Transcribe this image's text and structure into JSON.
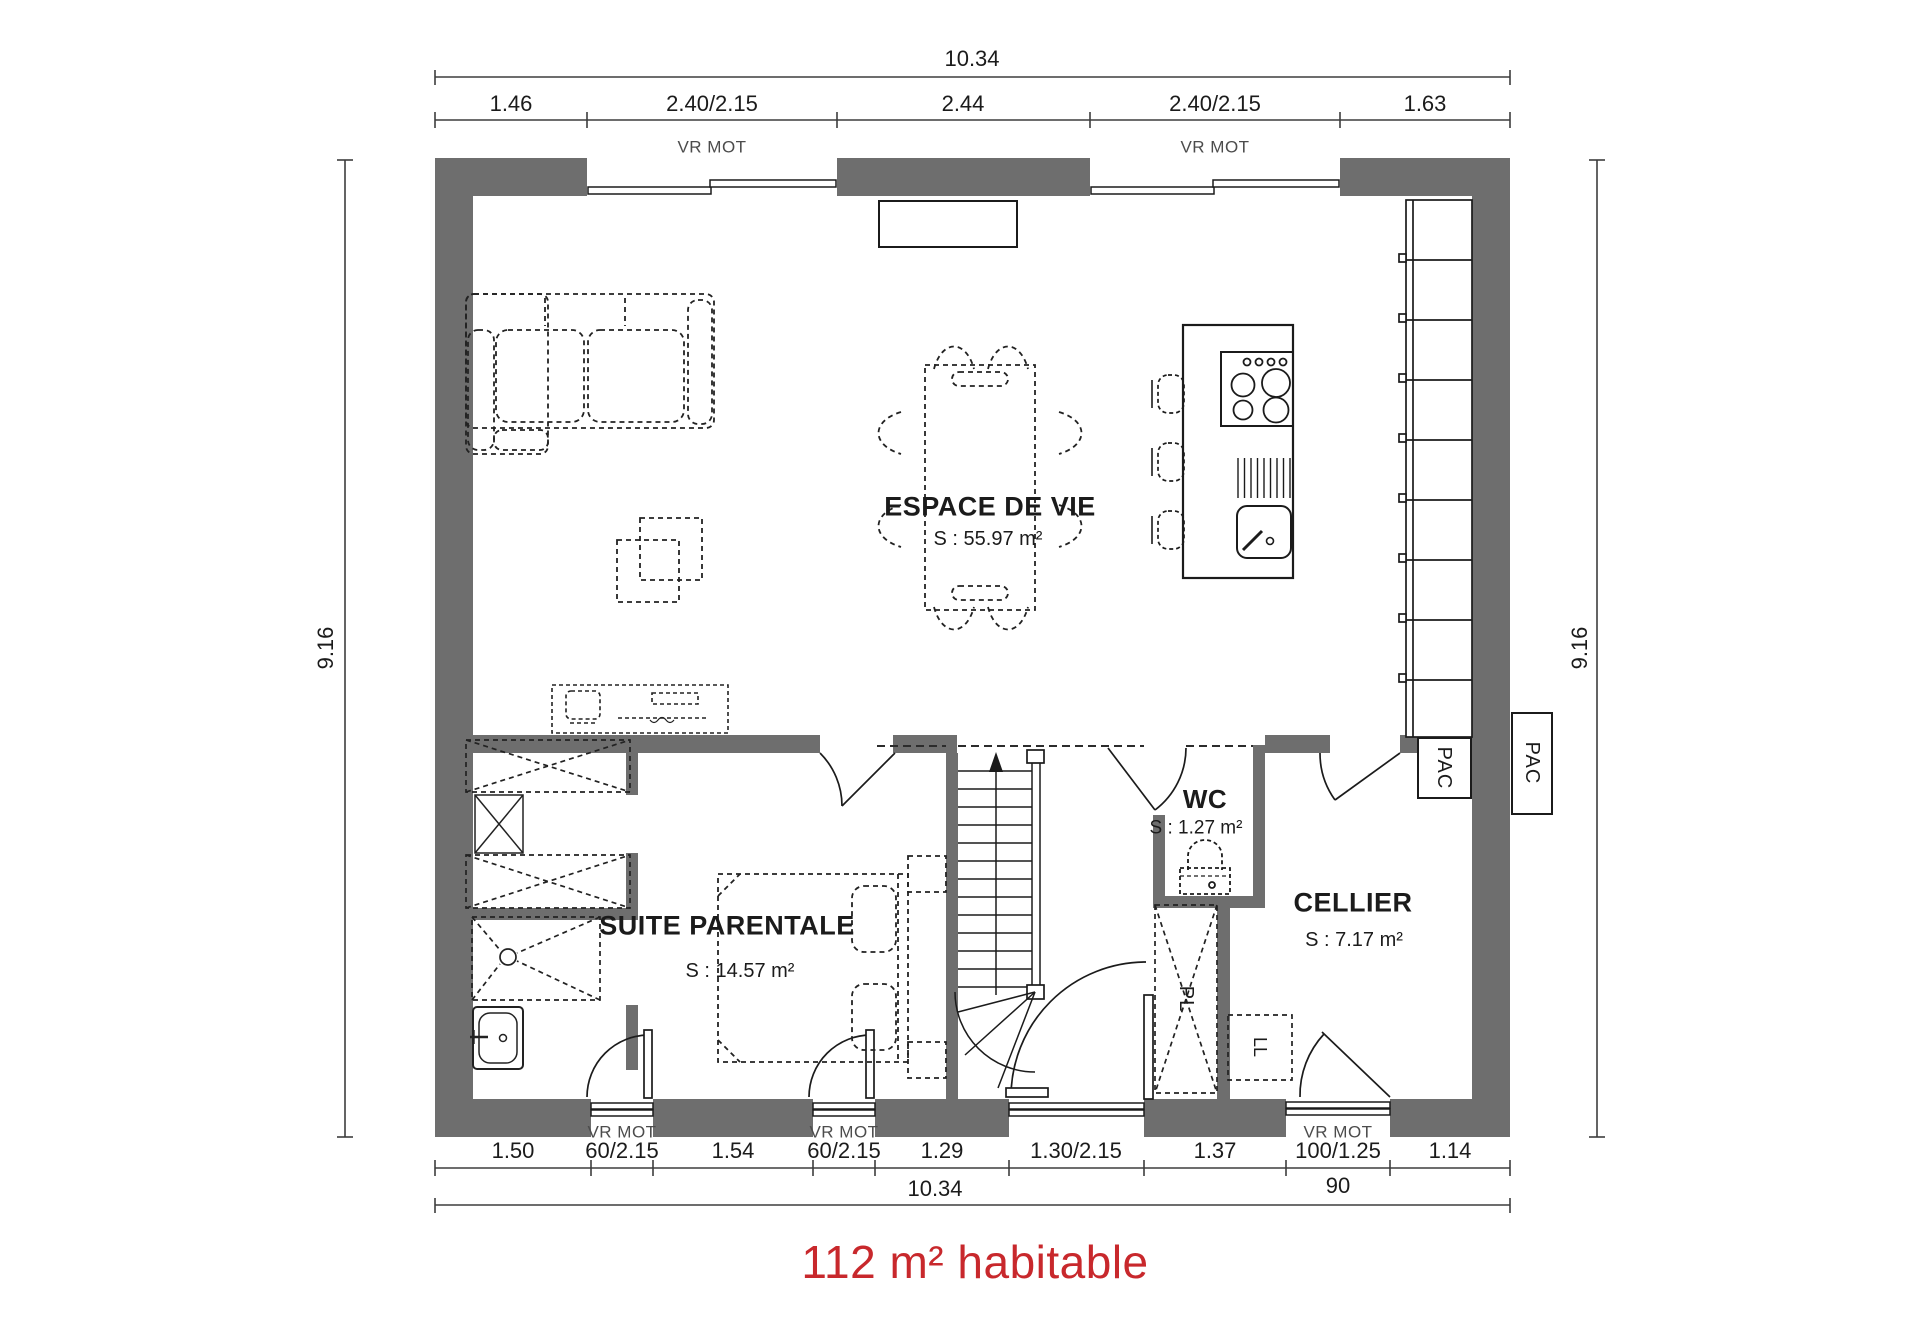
{
  "plan": {
    "title": "112 m² habitable",
    "title_color": "#c8282c",
    "rooms": {
      "living": {
        "name": "ESPACE DE VIE",
        "area": "S : 55.97 m²"
      },
      "suite": {
        "name": "SUITE PARENTALE",
        "area": "S : 14.57 m²"
      },
      "wc": {
        "name": "WC",
        "area": "S : 1.27 m²"
      },
      "cellier": {
        "name": "CELLIER",
        "area": "S : 7.17 m²"
      }
    },
    "equipment": {
      "pac": "PAC",
      "pl": "PL",
      "ll": "LL",
      "shutter": "VR MOT"
    },
    "dimensions": {
      "top": {
        "overall": "10.34",
        "segments": [
          "1.46",
          "2.40/2.15",
          "2.44",
          "2.40/2.15",
          "1.63"
        ]
      },
      "bottom": {
        "overall": "10.34",
        "segments": [
          "1.50",
          "60/2.15",
          "1.54",
          "60/2.15",
          "1.29",
          "1.30/2.15",
          "1.37",
          "100/1.25",
          "1.14"
        ],
        "door_swing": "90"
      },
      "left": "9.16",
      "right": "9.16"
    }
  }
}
